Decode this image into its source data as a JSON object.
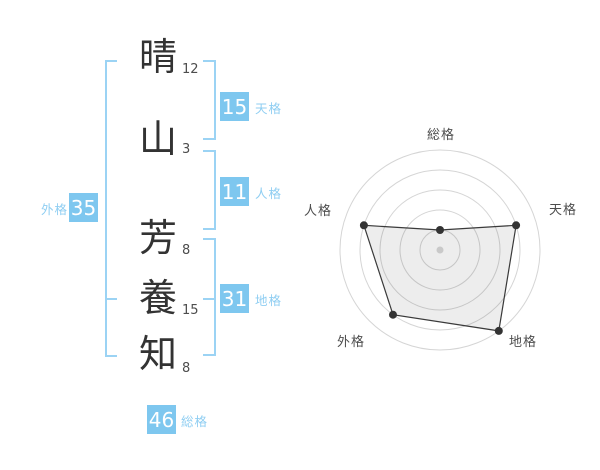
{
  "page": {
    "background": "#ffffff",
    "accent_blue": "#7ec7ef",
    "label_blue": "#8fcef2",
    "bracket_blue": "#9bd3f4"
  },
  "name_analysis": {
    "characters": [
      {
        "char": "晴",
        "strokes": "12"
      },
      {
        "char": "山",
        "strokes": "3"
      },
      {
        "char": "芳",
        "strokes": "8"
      },
      {
        "char": "養",
        "strokes": "15"
      },
      {
        "char": "知",
        "strokes": "8"
      }
    ],
    "categories": {
      "tenkaku": {
        "label": "天格",
        "value": "15"
      },
      "jinkaku": {
        "label": "人格",
        "value": "11"
      },
      "chikaku": {
        "label": "地格",
        "value": "31"
      },
      "gaikaku": {
        "label": "外格",
        "value": "35"
      },
      "soukaku": {
        "label": "総格",
        "value": "46"
      }
    }
  },
  "chart_data": {
    "type": "radar",
    "categories": [
      "総格",
      "天格",
      "地格",
      "外格",
      "人格"
    ],
    "values": [
      1,
      4,
      5,
      4,
      4
    ],
    "max": 5,
    "rings": 5,
    "start_angle_deg": 90,
    "direction": "clockwise",
    "grid": "concentric-circles",
    "legend": "none",
    "styles": {
      "ring": "#d5d5d5",
      "line": "#3a3a3a",
      "area_fill": "rgba(0,0,0,0.07)",
      "vertex_dot": "#333333",
      "center_dot": "#c9c9c9"
    }
  }
}
